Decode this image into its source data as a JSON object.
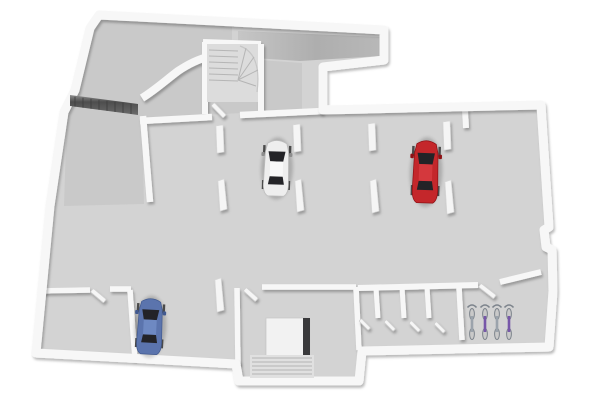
{
  "scene": {
    "type": "architectural-floor-plan-3d-render",
    "view": "top-down perspective",
    "rooms": [
      "entry-area",
      "ramp-corridor",
      "winder-stairwell",
      "parking-hall",
      "storage-room-bottom-left",
      "stair-and-elevator-room",
      "storage-compartments",
      "bicycle-room"
    ],
    "vehicles": [
      {
        "type": "car",
        "color_name": "white"
      },
      {
        "type": "car",
        "color_name": "red"
      },
      {
        "type": "car",
        "color_name": "blue"
      }
    ],
    "bicycles": {
      "count": 4,
      "frame_colors": [
        "silver",
        "purple",
        "silver",
        "purple"
      ]
    },
    "features": [
      "garage-gate",
      "winding-staircase",
      "straight-staircase",
      "elevator",
      "parking-dividers",
      "open-doors"
    ],
    "parking_divider_count": 4,
    "storage_door_count": 4
  },
  "colors": {
    "background": "#ffffff",
    "floor": "#d3d3d3",
    "floor_entry": "#c9c9c9",
    "ramp_light": "#c6c6c6",
    "ramp_dark": "#aeaeae",
    "wall": "#f7f7f7",
    "gate_front": "#4e4e4e",
    "gate_top": "#8f8f8f",
    "stair_fill": "#dcdcdc",
    "stair_bottom_fill": "#e0e0e0",
    "elevator_car": "#f2f2f2",
    "elevator_dark": "#3a3a3c",
    "door": "#f6f6f6",
    "car_window": "#232327",
    "car_white_body": "#eeeeee",
    "car_white_roof": "#f8f8f8",
    "car_red_body": "#c4272b",
    "car_red_roof": "#d4383d",
    "car_blue_body": "#5b74ad",
    "car_blue_roof": "#6e89c2",
    "wheel": "#4a4a4a",
    "shadow": "#9a9a9a",
    "bike_silver": "#9ba3ac",
    "bike_purple": "#7757a9",
    "bike_metal": "#7d848c"
  }
}
